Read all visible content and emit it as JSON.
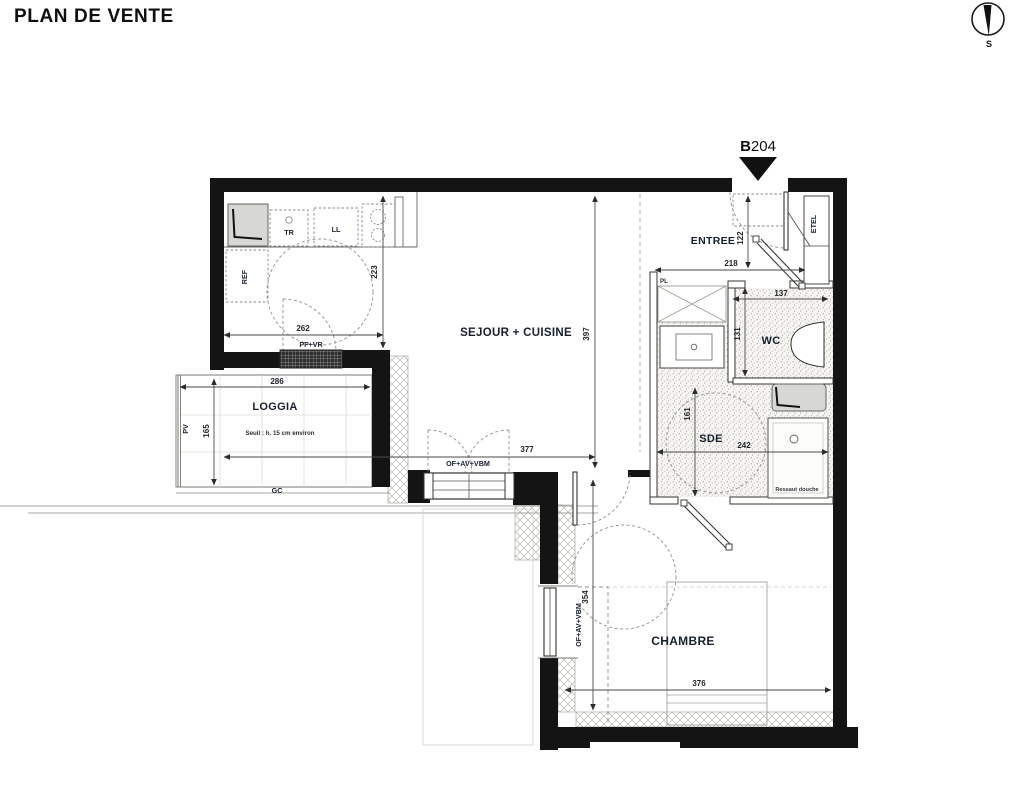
{
  "title": "PLAN DE VENTE",
  "compass": {
    "south": "S"
  },
  "unit": {
    "building": "B",
    "number": "204"
  },
  "rooms": {
    "sejour": "SEJOUR + CUISINE",
    "entree": "ENTREE",
    "wc": "WC",
    "sde": "SDE",
    "chambre": "CHAMBRE",
    "loggia": "LOGGIA"
  },
  "notes": {
    "seuil": "Seuil : h. 15 cm environ",
    "ressaut": "Ressaut douche"
  },
  "fixtures": {
    "ref": "REF",
    "tr": "TR",
    "ll": "LL",
    "pl": "PL",
    "etel": "ETEL"
  },
  "openings": {
    "pf_vr": "PF+VR",
    "sejour_window": "OF+AV+VBM",
    "chambre_window": "OF+AV+VBM",
    "gc": "GC",
    "pv": "PV"
  },
  "dimensions": {
    "kitchen_depth": "223",
    "kitchen_width": "262",
    "loggia_width": "286",
    "loggia_depth": "165",
    "sejour_depth": "397",
    "sejour_width": "377",
    "entree_width": "218",
    "entree_depth": "122",
    "wc_width": "137",
    "wc_depth": "131",
    "sde_width": "242",
    "sde_depth": "161",
    "chambre_width": "376",
    "chambre_depth": "354"
  },
  "colors": {
    "wall": "#141414",
    "label": "#1a2133",
    "dimension": "#23232a",
    "hatch": "#b8b8b2"
  }
}
